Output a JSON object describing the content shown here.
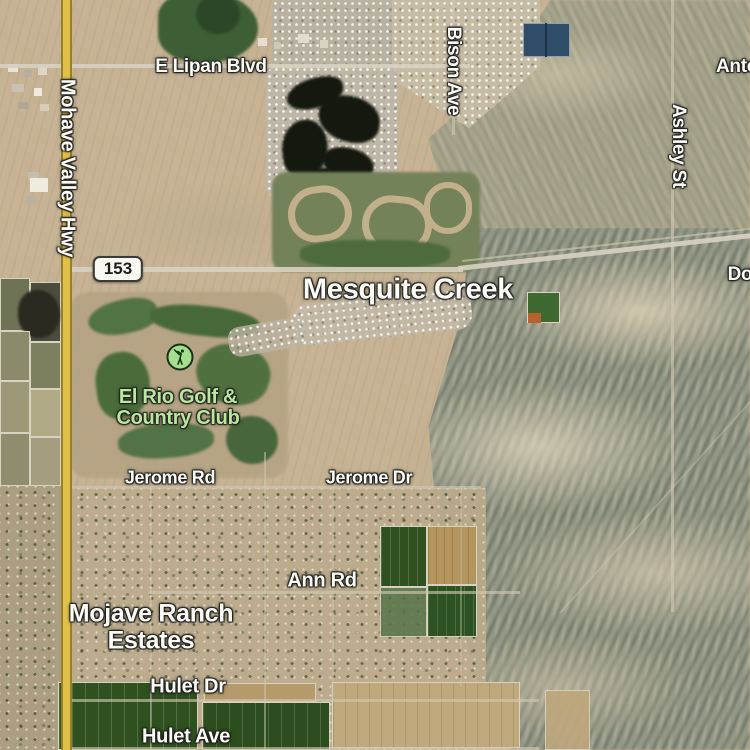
{
  "map": {
    "view": "satellite",
    "locality_labels": [
      "Mesquite Creek",
      "Mojave Ranch Estates"
    ],
    "route_shield": "153"
  },
  "labels": {
    "mohave_valley_hwy": "Mohave Valley Hwy",
    "e_lipan_blvd": "E Lipan Blvd",
    "bison_ave": "Bison Ave",
    "antelope_partial": "Anto",
    "ashley_st": "Ashley St",
    "dome_partial": "Do",
    "route_shield": "153",
    "mesquite_creek": "Mesquite Creek",
    "el_rio_line1": "El Rio Golf &",
    "el_rio_line2": "Country Club",
    "jerome_rd": "Jerome Rd",
    "jerome_dr": "Jerome Dr",
    "ann_rd": "Ann Rd",
    "mojave_ranch_line1": "Mojave Ranch",
    "mojave_ranch_line2": "Estates",
    "hulet_dr": "Hulet Dr",
    "hulet_ave": "Hulet Ave"
  },
  "icons": {
    "golf_poi": "golfer-swing-icon"
  },
  "colors": {
    "highway_yellow": "#e2c14b",
    "label_white": "#fcfbf8",
    "poi_label_green": "#b9e79f",
    "poi_badge_green": "#a7de8e",
    "shield_background": "#faf8f2",
    "lake_water_dark": "#15180f",
    "farm_field_green": "#2f5120",
    "desert_tan": "#c7b394",
    "mountain_gray": "#939887",
    "solar_pond_blue": "#2f4d69"
  }
}
